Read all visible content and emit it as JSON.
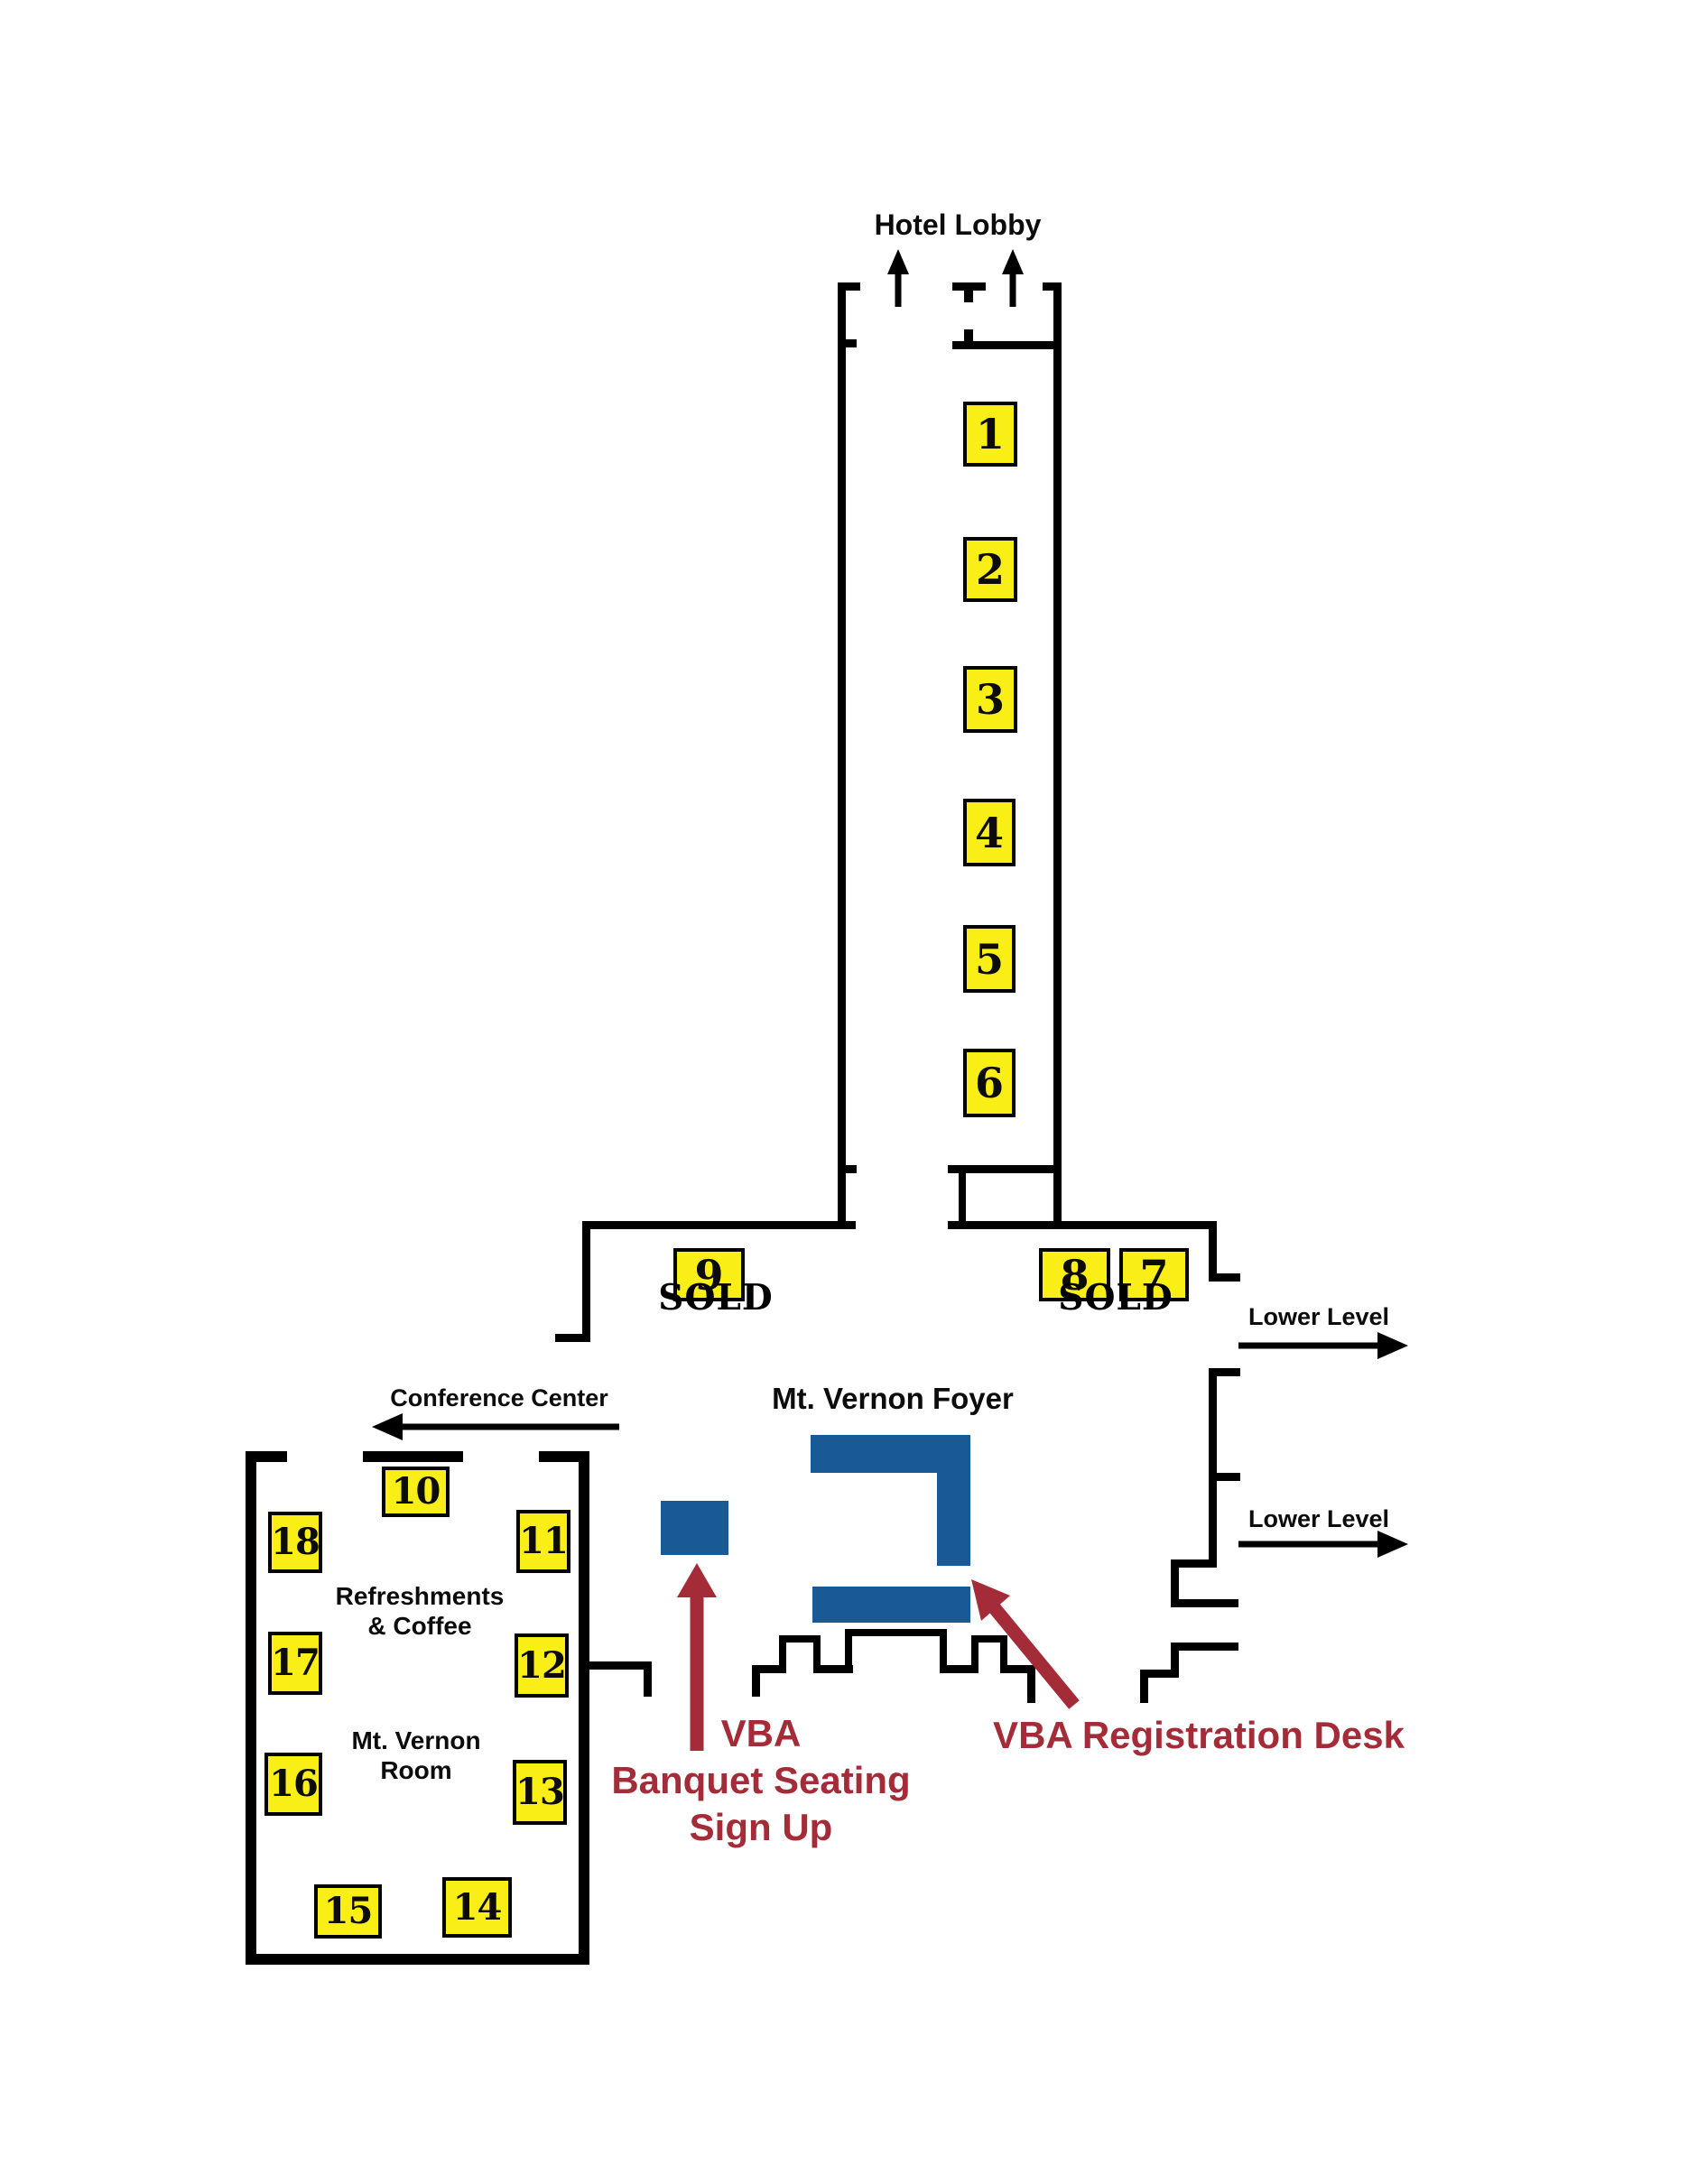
{
  "title": "Hotel exhibitor booth floor plan",
  "colors": {
    "bg": "#ffffff",
    "wall": "#000000",
    "yellow": "#F9EE16",
    "blue": "#1A5A94",
    "red": "#A42C38"
  },
  "labels": {
    "hotel_lobby": "Hotel Lobby",
    "conference_center": "Conference Center",
    "mt_vernon_foyer": "Mt. Vernon Foyer",
    "lower_level_upper": "Lower Level",
    "lower_level_lower": "Lower Level",
    "refreshments_line1": "Refreshments",
    "refreshments_line2": "& Coffee",
    "room_line1": "Mt. Vernon",
    "room_line2": "Room",
    "sold_left": "SOLD",
    "sold_right": "SOLD",
    "banquet_line1": "VBA",
    "banquet_line2": "Banquet Seating",
    "banquet_line3": "Sign Up",
    "registration": "VBA Registration Desk"
  },
  "booths": {
    "b1": "1",
    "b2": "2",
    "b3": "3",
    "b4": "4",
    "b5": "5",
    "b6": "6",
    "b7": "7",
    "b8": "8",
    "b9": "9",
    "b10": "10",
    "b11": "11",
    "b12": "12",
    "b13": "13",
    "b14": "14",
    "b15": "15",
    "b16": "16",
    "b17": "17",
    "b18": "18"
  }
}
